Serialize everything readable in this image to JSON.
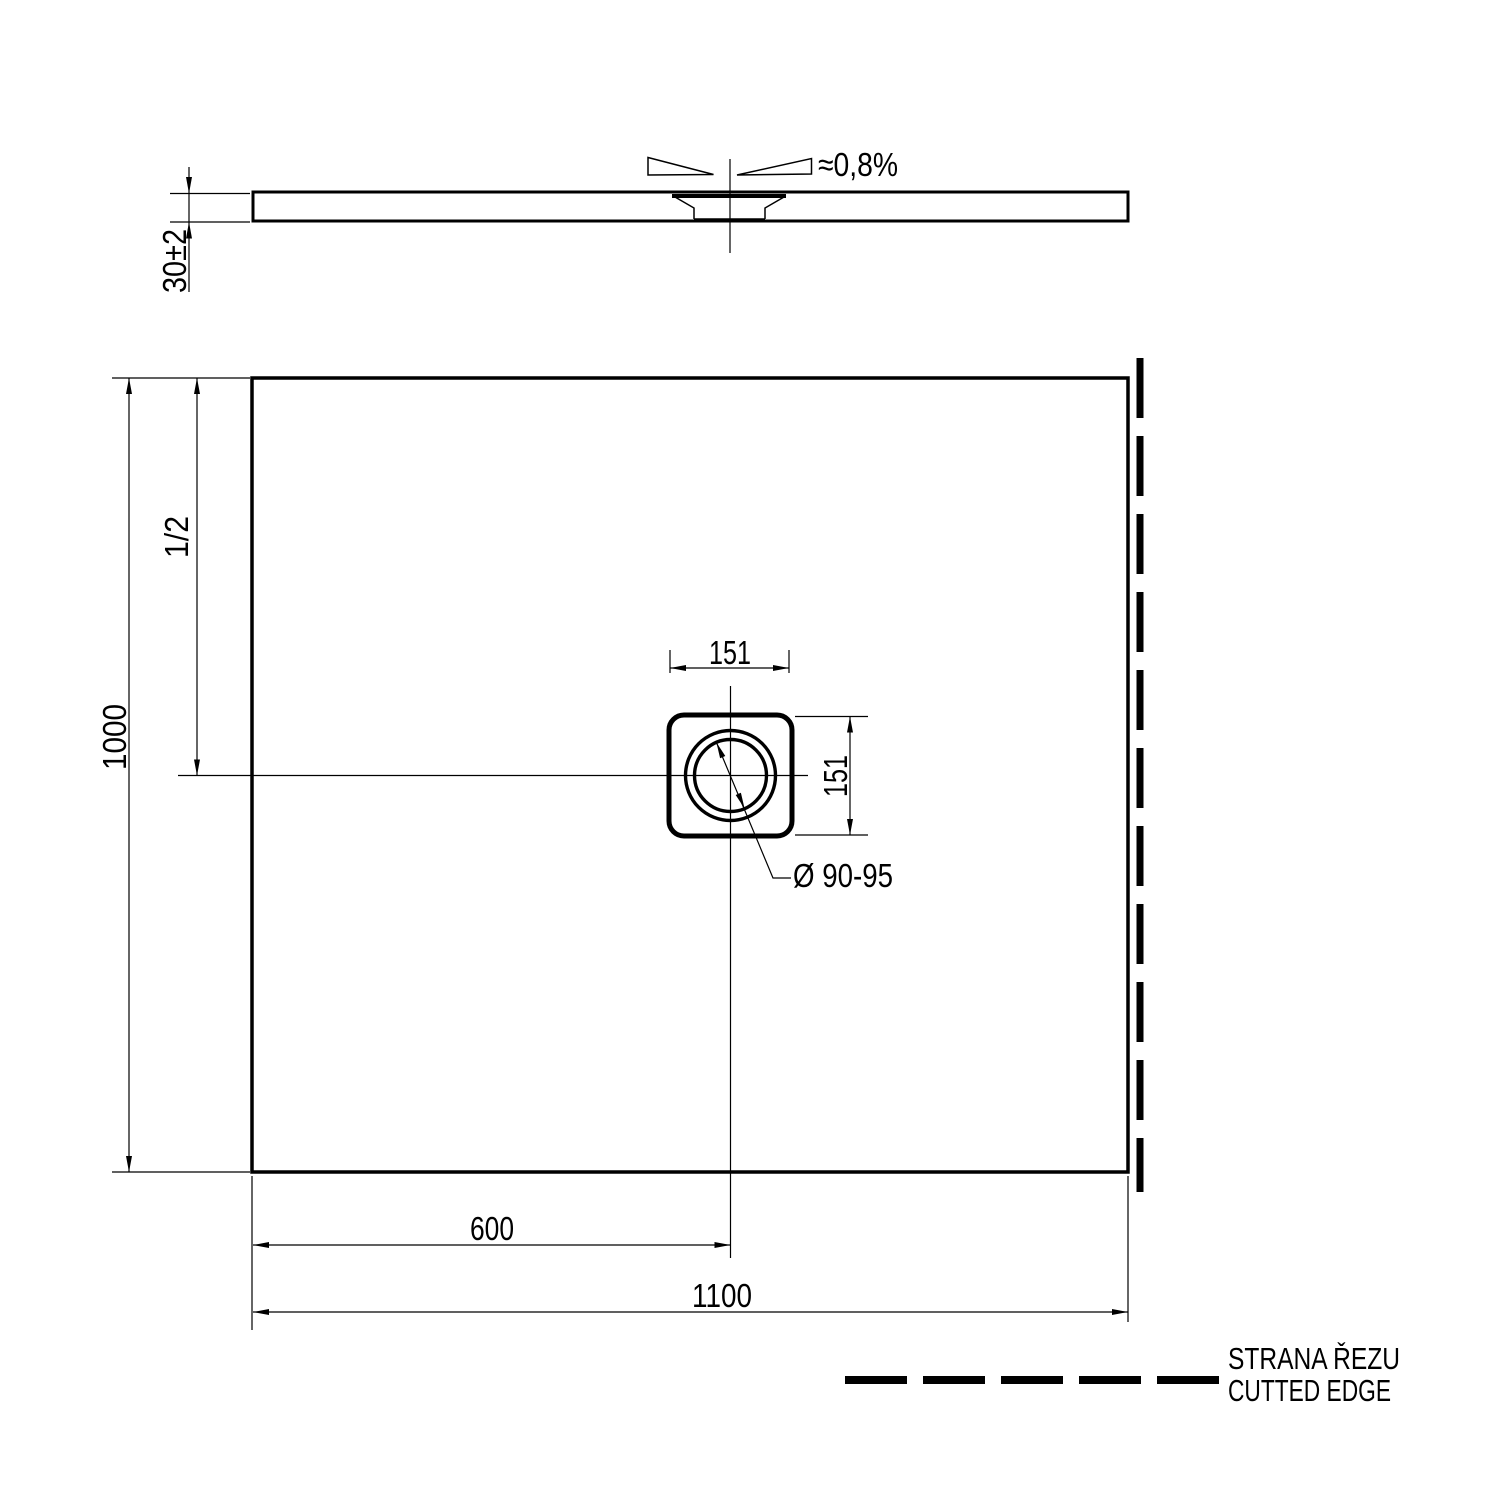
{
  "colors": {
    "line": "#000000",
    "background": "#ffffff"
  },
  "side_view": {
    "thickness_dim": "30±2",
    "slope_dim": "≈0,8%"
  },
  "plan_view": {
    "overall_height_dim": "1000",
    "half_height_dim": "1/2",
    "drain_square_width_dim": "151",
    "drain_square_height_dim": "151",
    "drain_diameter_dim": "Ø 90-95",
    "drain_offset_dim": "600",
    "overall_width_dim": "1100"
  },
  "legend": {
    "cut_edge_label_cs": "STRANA ŘEZU",
    "cut_edge_label_en": "CUTTED EDGE"
  }
}
